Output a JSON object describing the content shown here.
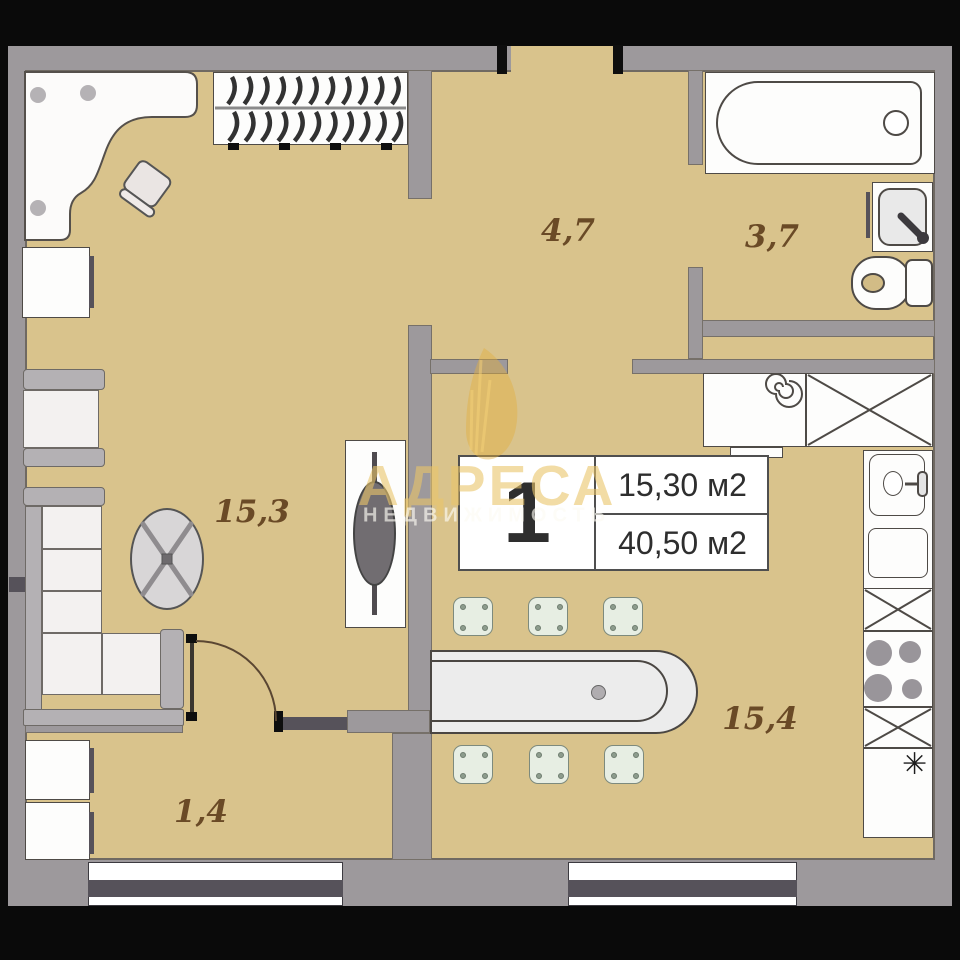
{
  "page": {
    "type": "apartment floor plan"
  },
  "watermark": {
    "brand": "АДРЕСА",
    "subtitle": "НЕДВИЖИМОСТЬ"
  },
  "info_box": {
    "number": "1",
    "room_area": "15,30 м2",
    "total_area": "40,50 м2"
  },
  "rooms": {
    "living": {
      "label": "15,3"
    },
    "hallway": {
      "label": "4,7"
    },
    "bathroom": {
      "label": "3,7"
    },
    "kitchen_living": {
      "label": "15,4"
    },
    "entry": {
      "label": "1,4"
    }
  },
  "icons": {
    "freezer_snowflake": "✳"
  },
  "colors": {
    "floor": "#d9c38c",
    "walls": "#9d999c",
    "room_label": "#6a4a26",
    "watermark_gold": "#e9c569",
    "window_stripe": "#56525a",
    "background": "#0a0a0a"
  }
}
